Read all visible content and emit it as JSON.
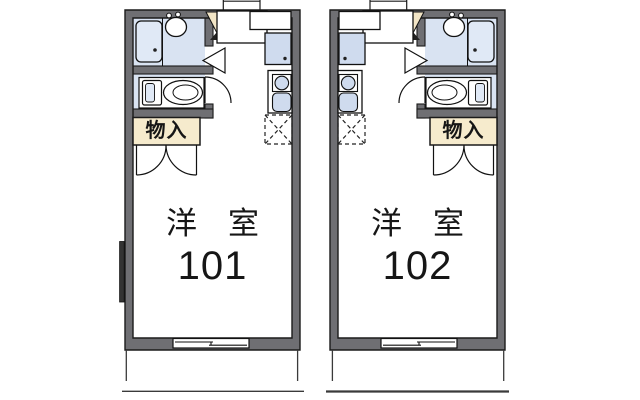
{
  "plan": {
    "type": "apartment-floor-plan",
    "units": [
      {
        "room_label": "洋　室",
        "room_number": "101",
        "storage_label": "物入"
      },
      {
        "room_label": "洋　室",
        "room_number": "102",
        "storage_label": "物入"
      }
    ]
  },
  "colors": {
    "wall": "#6f6f73",
    "sanitary_room": "#d9e3f2",
    "fixture_fill": "#cfdbee",
    "bathtub_fill": "#e0e9f6",
    "storage_bg": "#f6ebcd",
    "door_wedge": "#f2e5c6",
    "outline": "#1b1b1b",
    "background": "#ffffff"
  }
}
